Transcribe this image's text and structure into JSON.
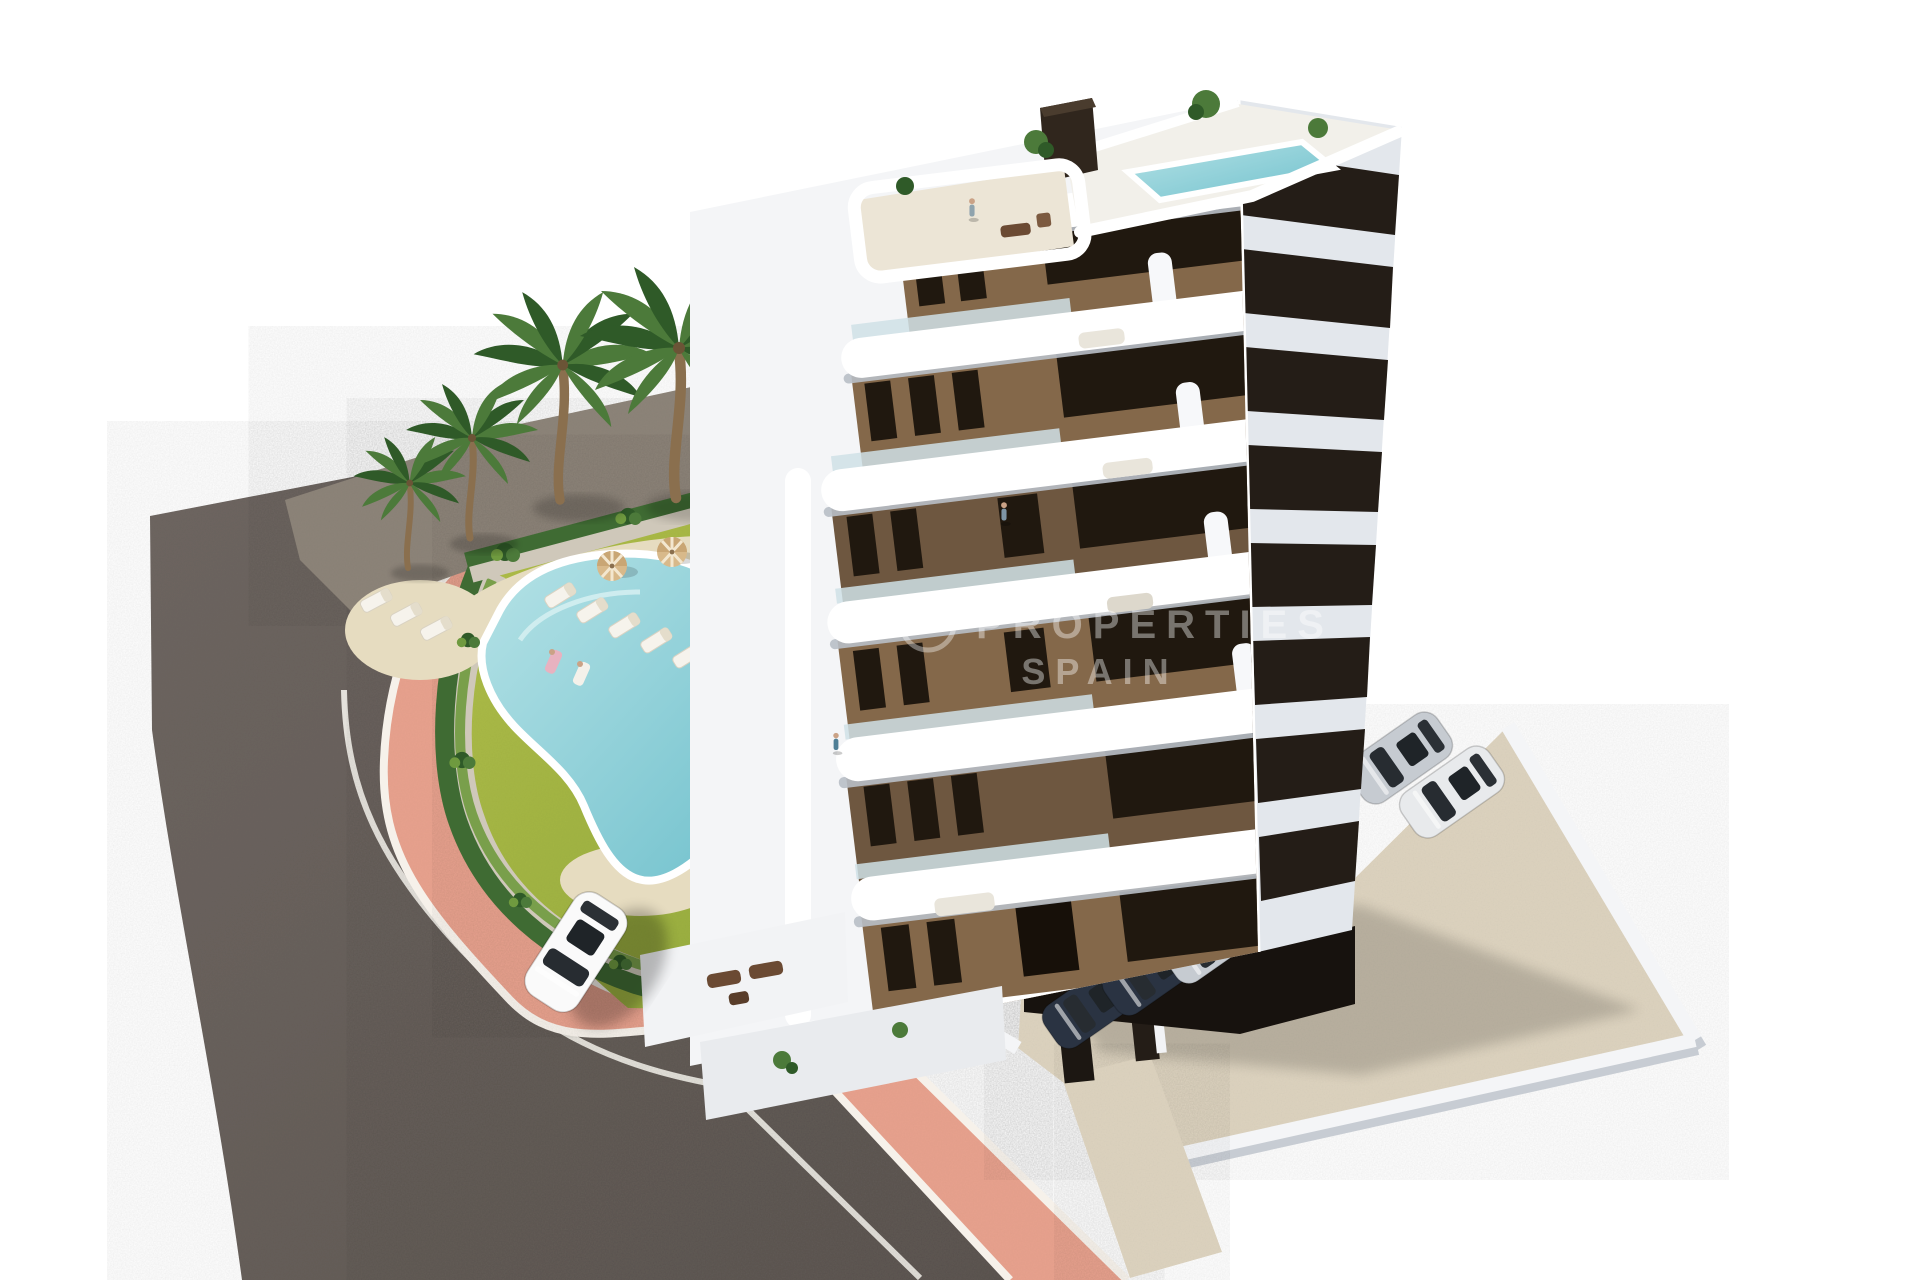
{
  "scene": {
    "type": "3d-architectural-rendering",
    "description": "Aerial 3D render of a modern 8-storey white apartment building with brown facade panels and curved white balconies, rooftop terrace with plunge pool, landscaped garden with kidney-shaped swimming pool, sun loungers and palm trees, pink promenade sidewalk, curved asphalt road with a white car, and a parking court with parked cars.",
    "watermark": {
      "line1": "PROPERTIES",
      "line2": "SPAIN"
    },
    "counts": {
      "floors_visible": 8,
      "street_cars": 1,
      "parked_cars_visible": 6,
      "palm_trees": 7,
      "sun_loungers": 8,
      "parasols": 2
    },
    "palette": {
      "bg": "#ffffff",
      "asphalt": "#6e6661",
      "asphalt_dark": "#5f5853",
      "unpaved": "#8d8479",
      "sidewalk": "#e8a28e",
      "sidewalk_deep": "#dd9480",
      "curb": "#f6f1ea",
      "hedge": "#3f6b33",
      "hedge_light": "#6f9a3f",
      "bed": "#cfc8ba",
      "lawn": "#b2bf49",
      "lawn_dark": "#8fa83c",
      "pool_water": "#6fc0cc",
      "pool_light": "#b5e2e6",
      "deck": "#e6dcc0",
      "white_build": "#f4f5f7",
      "white_shade": "#e3e7ec",
      "slab_shadow": "#b9bfc7",
      "facade_brown": "#84684a",
      "facade_brown_dark": "#6e5740",
      "facade_dark": "#241d17",
      "window_dark": "#20180f",
      "glass": "#cfe0e6",
      "concrete": "#ddd3bf",
      "soffit": "#17120e",
      "car_white": "#fafafa",
      "car_silver": "#c6cbd1",
      "car_navy": "#2a3342",
      "trunk": "#8a6f4e",
      "palm_green": "#4c7a3a",
      "palm_dark": "#2f5a28",
      "watermark": "#ffffff"
    }
  }
}
